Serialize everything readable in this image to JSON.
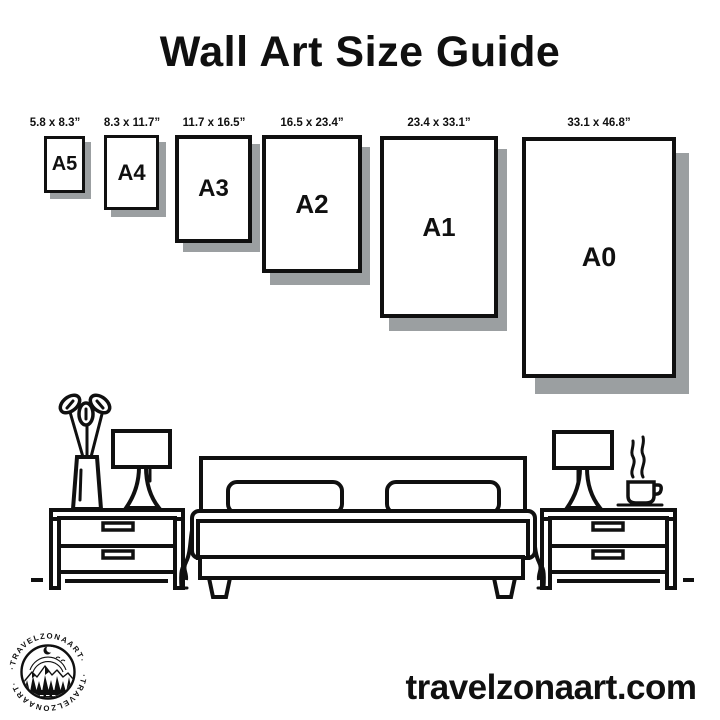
{
  "title": "Wall Art Size Guide",
  "sizes": [
    {
      "code": "A5",
      "label": "5.8 x 8.3”"
    },
    {
      "code": "A4",
      "label": "8.3 x 11.7”"
    },
    {
      "code": "A3",
      "label": "11.7 x 16.5”"
    },
    {
      "code": "A2",
      "label": "16.5 x 23.4”"
    },
    {
      "code": "A1",
      "label": "23.4 x 33.1”"
    },
    {
      "code": "A0",
      "label": "33.1 x 46.8”"
    }
  ],
  "logo": {
    "ring_text": "·TRAVELZONAART·"
  },
  "footer": {
    "website": "travelzonaart.com"
  },
  "colors": {
    "background": "#ffffff",
    "ink": "#101010",
    "frame_shadow": "#9b9fa1"
  },
  "illustration": {
    "scene": "bedroom",
    "items": [
      "potted-plant",
      "table-lamp-left",
      "nightstand-left",
      "double-bed",
      "nightstand-right",
      "table-lamp-right",
      "coffee-cup"
    ]
  }
}
